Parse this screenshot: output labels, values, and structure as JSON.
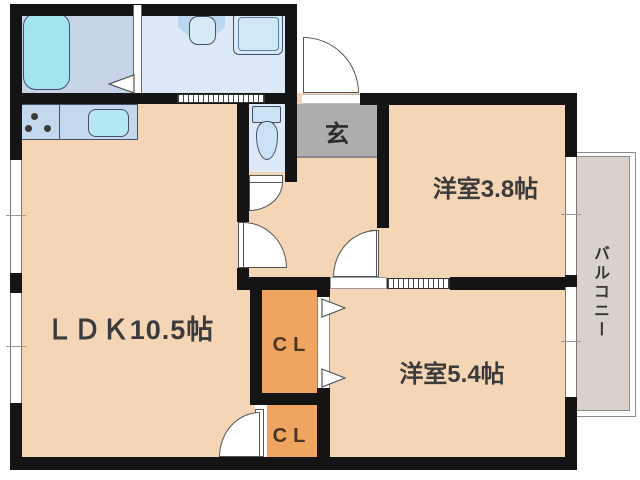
{
  "plan": {
    "rooms": {
      "ldk": "ＬＤＫ10.5帖",
      "western_38": "洋室3.8帖",
      "western_54": "洋室5.4帖",
      "entrance": "玄",
      "closet_upper": "CL",
      "closet_lower": "CL",
      "balcony": "バルコニー"
    },
    "colors": {
      "floor": "#F4D5B5",
      "closet": "#EFA55F",
      "entrance_floor": "#ADADAD",
      "bathroom": "#C7D4E8",
      "washroom": "#DEE9F7",
      "toilet_room": "#DEE9F7",
      "fixture_fill": "#D8EAF8",
      "bathtub_fill": "#A3E4EF",
      "sink_fill": "#B5E8F1",
      "kitchen_counter": "#C3D8ED",
      "balcony_fill": "#D9D2CB",
      "wall": "#141414"
    }
  }
}
